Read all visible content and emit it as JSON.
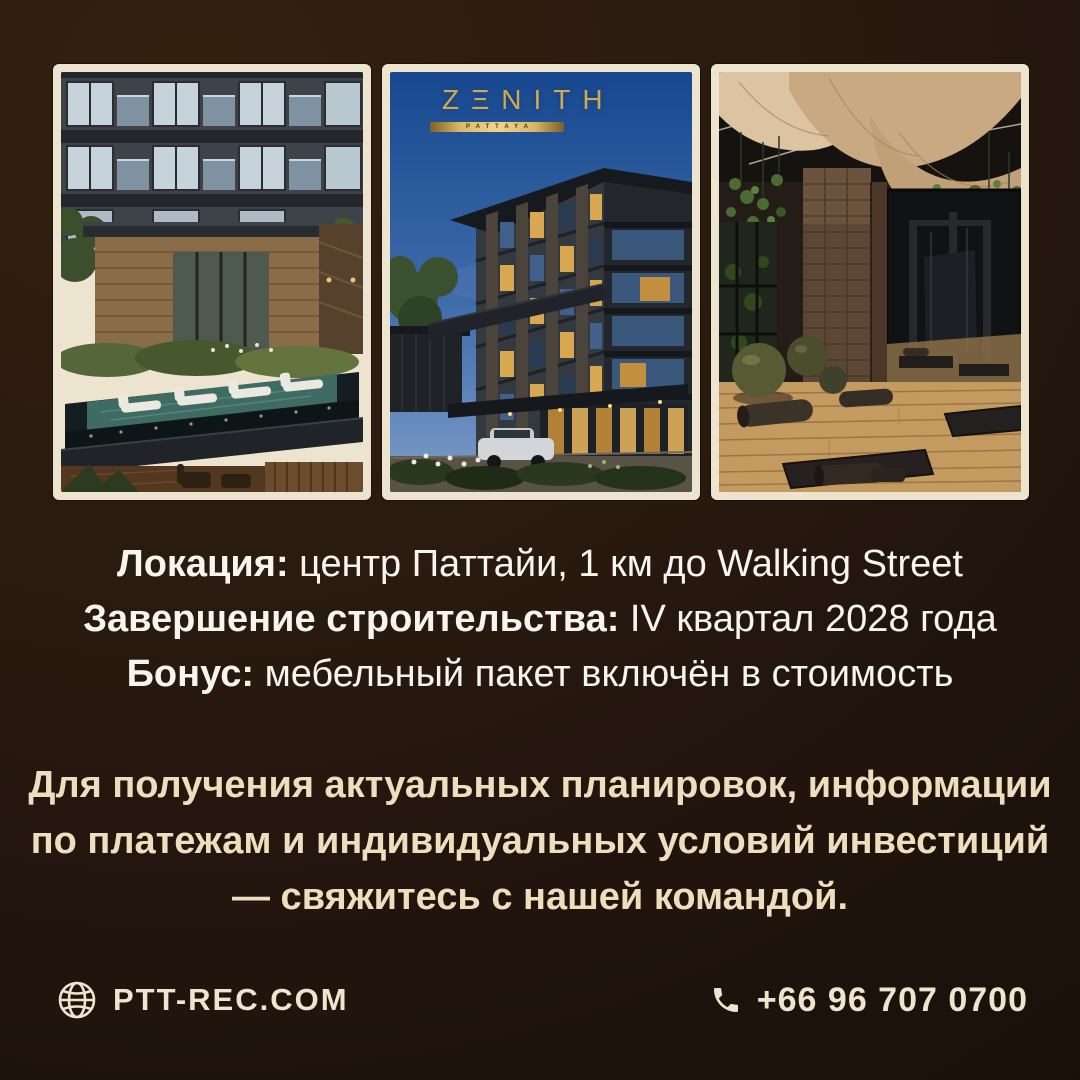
{
  "theme": {
    "bg-top": "#33200f",
    "bg-bottom": "#191009",
    "frame-cream": "#ede4cf",
    "text-white": "#f8f4ee",
    "text-beige": "#eddfbd",
    "footer-cream": "#efe5cf",
    "logo-gold": "#cfa851"
  },
  "brand": {
    "logo_text": "ZΞNITH",
    "logo_subtext": "PATTAYA"
  },
  "photos": [
    {
      "id": "exterior-pool-photo"
    },
    {
      "id": "zenith-building-render-photo"
    },
    {
      "id": "gym-interior-photo"
    }
  ],
  "details": {
    "lines": [
      {
        "label": "Локация:",
        "text": " центр Паттайи, 1 км до Walking Street"
      },
      {
        "label": "Завершение строительства:",
        "text": " IV квартал 2028 года"
      },
      {
        "label": "Бонус:",
        "text": " мебельный пакет включён в стоимость"
      }
    ]
  },
  "cta": {
    "lines": [
      "Для получения актуальных планировок, информации",
      "по платежам и индивидуальных условий инвестиций",
      "— свяжитесь с нашей командой."
    ]
  },
  "footer": {
    "website": "PTT-REC.COM",
    "phone": "+66 96 707 0700",
    "icons": {
      "website": "globe-icon",
      "phone": "phone-icon"
    }
  }
}
